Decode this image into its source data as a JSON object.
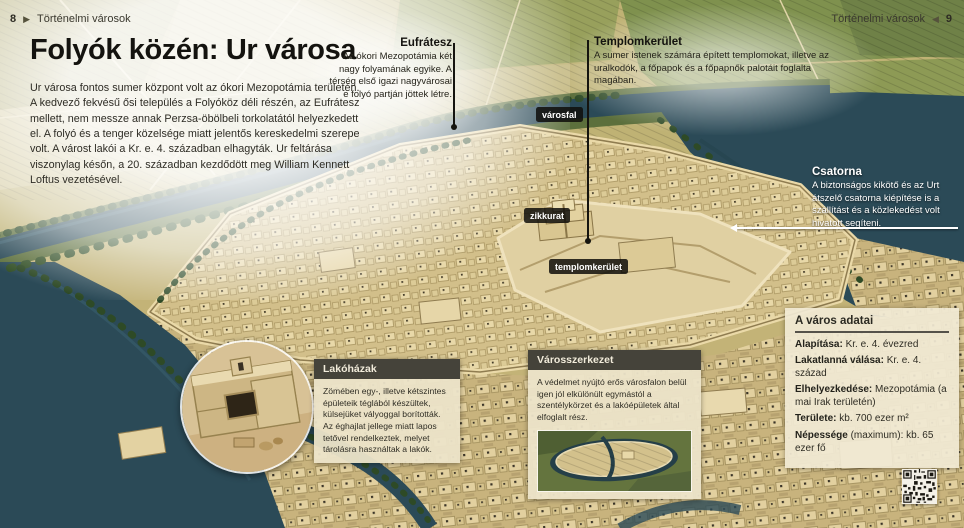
{
  "page_header": {
    "arrow_right": "▶",
    "arrow_left": "◀",
    "left": {
      "number": "8",
      "label": "Történelmi városok"
    },
    "right": {
      "number": "9",
      "label": "Történelmi városok"
    }
  },
  "title": {
    "regular": "Folyók közén: ",
    "bold": "Ur városa"
  },
  "intro": {
    "text": "Ur városa fontos sumer központ volt az ókori Mezopotámia területén. A kedvező fekvésű ősi település a Folyóköz déli részén, az Eufrátesz mellett, nem messze annak Perzsa-öbölbeli torkolatától helyezkedett el. A folyó és a tenger közelsége miatt jelentős kereskedelmi szerepe volt. A várost lakói a Kr. e. 4. században elhagyták. Ur feltárása viszonylag későn, a 20. században kezdődött meg William Kennett Loftus vezetésével."
  },
  "callouts": {
    "eufratesz": {
      "title": "Eufrátesz",
      "body": "Az ókori Mezopotámia két nagy folyamának egyike. A térség első igazi nagyvárosai e folyó partján jöttek létre."
    },
    "templomkerulet": {
      "title": "Templomkerület",
      "body": "A sumer istenek számára épített templomokat, illetve az uralkodók, a főpapok és a főpapnők palotáit foglalta magában."
    },
    "csatorna": {
      "title": "Csatorna",
      "body": "A biztonságos kikötő és az Urt átszelő csatorna kiépítése is a szállítást és a közlekedést volt hivatott segíteni."
    }
  },
  "map_labels": {
    "varosfal": "városfal",
    "zikkurat": "zikkurat",
    "templomkerulet": "templomkerület"
  },
  "info_boxes": {
    "lakohazak": {
      "title": "Lakóházak",
      "body": "Zömében egy-, illetve kétszintes épületeik téglából készültek, külsejüket vályoggal borították. Az éghajlat jellege miatt lapos tetővel rendelkeztek, melyet tárolásra használtak a lakók."
    },
    "varosszerkezet": {
      "title": "Városszerkezet",
      "body": "A védelmet nyújtó erős városfalon belül igen jól elkülönült egymástól a szentélykörzet és a lakóépületek által elfoglalt rész."
    }
  },
  "city_facts": {
    "title": "A város adatai",
    "rows": [
      {
        "label": "Alapítása:",
        "value": " Kr. e. 4. évezred"
      },
      {
        "label": "Lakatlanná válása:",
        "value": " Kr. e. 4. század"
      },
      {
        "label": "Elhelyezkedése:",
        "value": " Mezopotámia (a mai Irak területén)"
      },
      {
        "label": "Területe:",
        "value": " kb. 700 ezer m²"
      },
      {
        "label": "Népessége",
        "value": " (maximum): kb. 65 ezer fő"
      }
    ]
  },
  "icons": {
    "qr_code": "qr-code",
    "leader_dot": "leader-line-dot",
    "arrow_left_white": "white-arrow-left"
  },
  "colors": {
    "river": "#2b4a57",
    "field_tan": "#c3b377",
    "box_header": "#45433a",
    "box_body": "#ece4c9",
    "pill_bg": "#0f0e0a",
    "text_dark": "#2e2c25"
  }
}
